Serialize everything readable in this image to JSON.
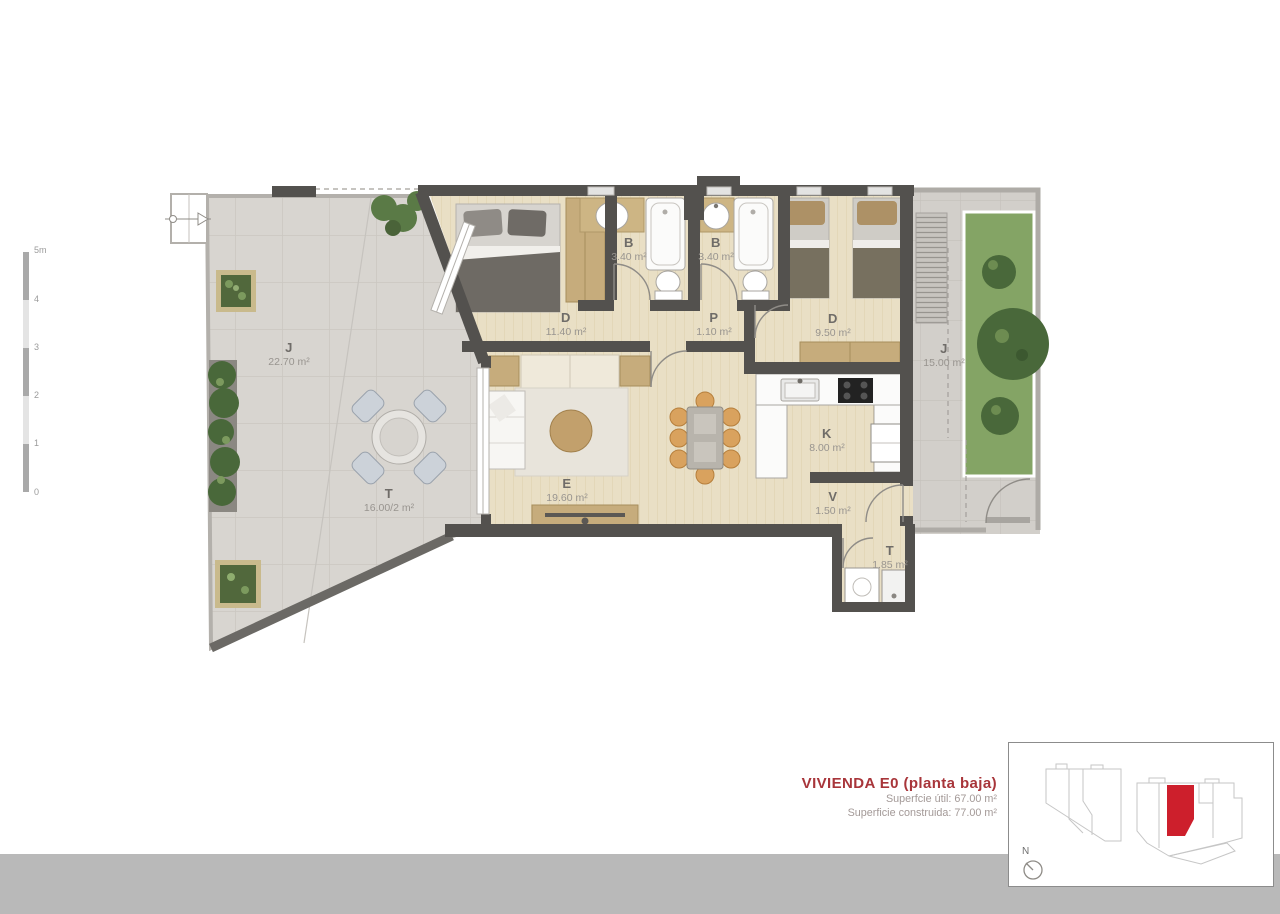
{
  "plan": {
    "rooms": [
      {
        "code": "J",
        "area": "22.70 m²"
      },
      {
        "code": "T",
        "area": "16.00/2 m²"
      },
      {
        "code": "D",
        "area": "11.40 m²"
      },
      {
        "code": "B",
        "area": "3.40 m²"
      },
      {
        "code": "B",
        "area": "3.40 m²"
      },
      {
        "code": "P",
        "area": "1.10 m²"
      },
      {
        "code": "D",
        "area": "9.50 m²"
      },
      {
        "code": "K",
        "area": "8.00 m²"
      },
      {
        "code": "V",
        "area": "1.50 m²"
      },
      {
        "code": "E",
        "area": "19.60 m²"
      },
      {
        "code": "T",
        "area": "1.85 m²"
      },
      {
        "code": "J",
        "area": "15.00 m²"
      }
    ]
  },
  "scale_bar": {
    "labels": [
      "5m",
      "4",
      "3",
      "2",
      "1",
      "0"
    ]
  },
  "title_block": {
    "title": "VIVIENDA E0 (planta baja)",
    "line1": "Superfcie útil: 67.00 m²",
    "line2": "Superficie construida: 77.00 m²"
  },
  "locator": {
    "north_label": "N"
  },
  "colors": {
    "accent_red": "#a8353a",
    "locator_red": "#cd1f2c",
    "footer_gray": "#b9b9b9",
    "wall_dark": "#53514e",
    "wood_floor": "#e9dfc5",
    "stone_terrace": "#d8d5d0",
    "grass_green": "#84a465"
  }
}
